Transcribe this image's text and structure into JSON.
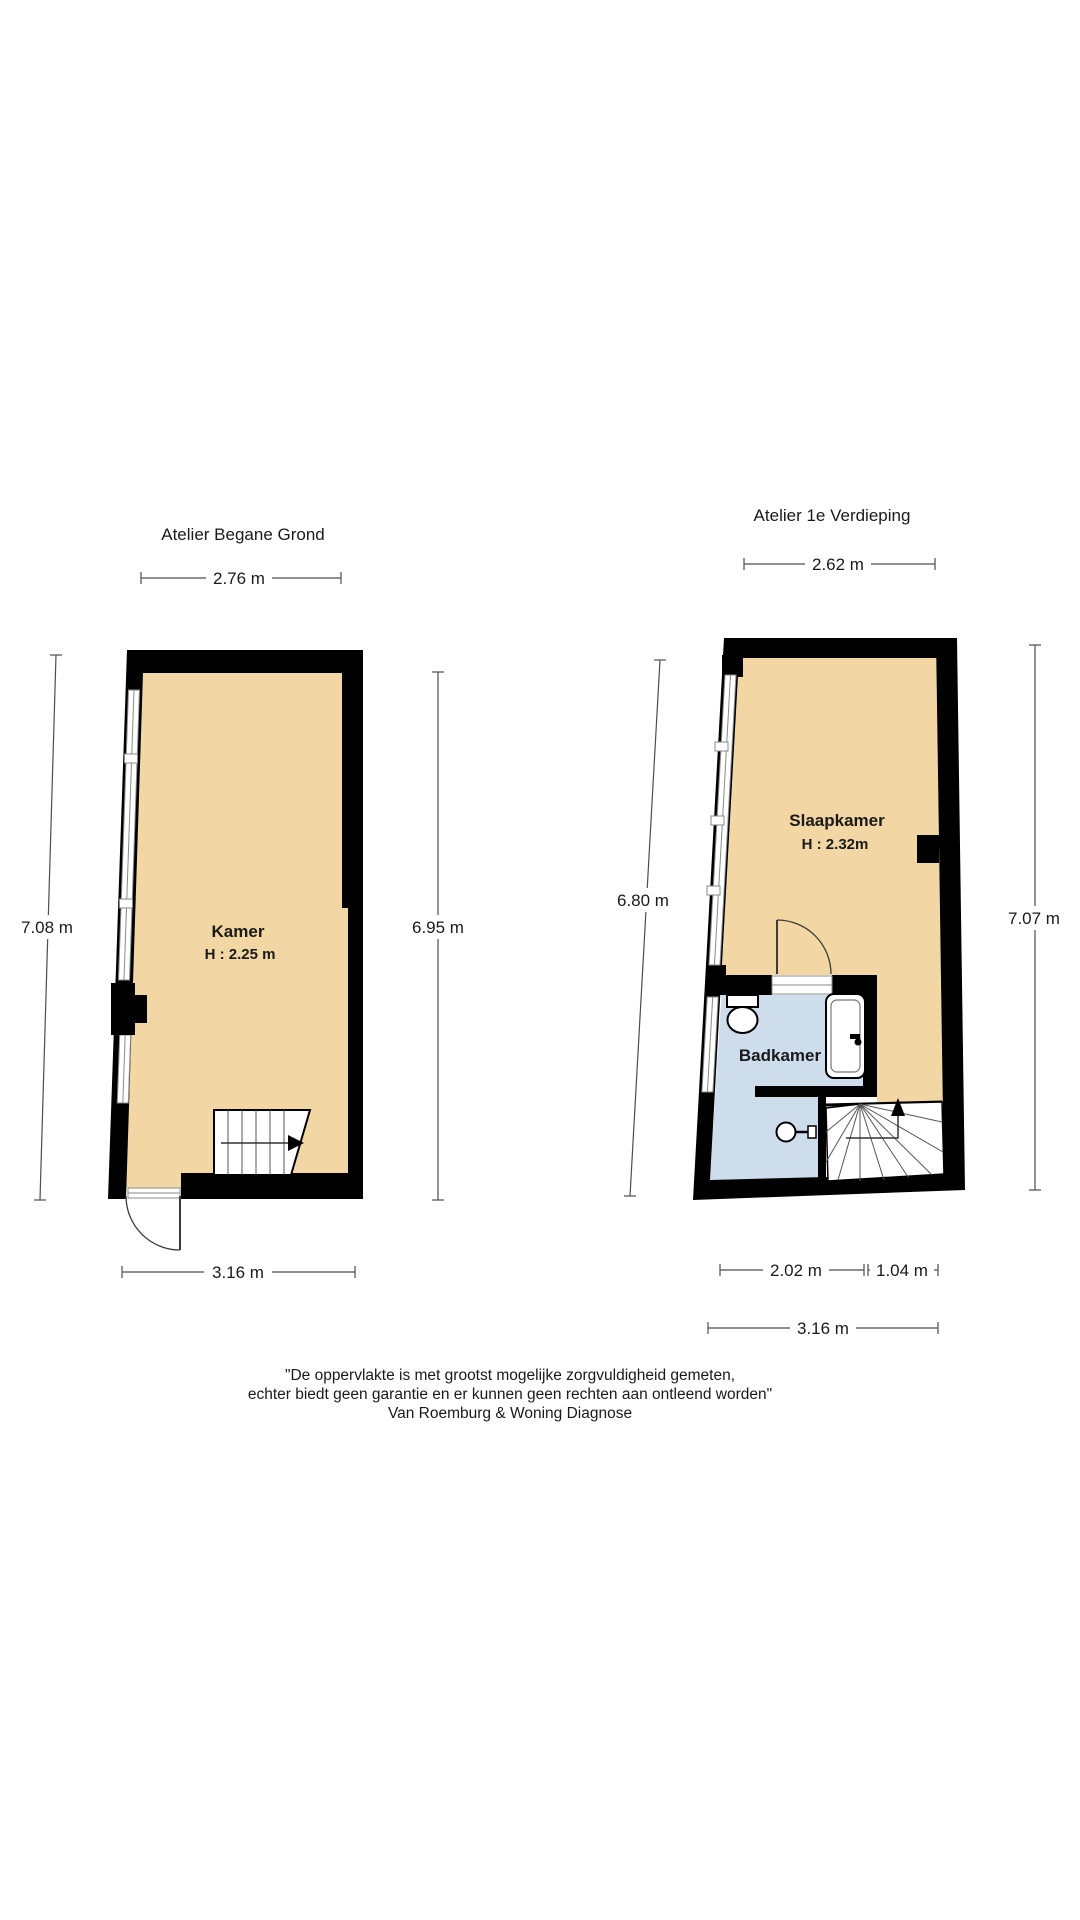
{
  "colors": {
    "wall": "#000000",
    "floor": "#F2D6A4",
    "bathroom": "#CEDDEC",
    "background": "#ffffff"
  },
  "ground_floor": {
    "title": "Atelier Begane Grond",
    "room_label": "Kamer",
    "room_height": "H : 2.25 m",
    "dim_top": "2.76 m",
    "dim_left": "7.08 m",
    "dim_right": "6.95 m",
    "dim_bottom": "3.16 m"
  },
  "first_floor": {
    "title": "Atelier 1e Verdieping",
    "slaapkamer_label": "Slaapkamer",
    "slaapkamer_height": "H : 2.32m",
    "badkamer_label": "Badkamer",
    "dim_top": "2.62 m",
    "dim_left": "6.80 m",
    "dim_right": "7.07 m",
    "dim_bottom_left": "2.02 m",
    "dim_bottom_right": "1.04 m",
    "dim_bottom_total": "3.16 m"
  },
  "disclaimer": {
    "line1": "\"De oppervlakte is met grootst mogelijke zorgvuldigheid gemeten,",
    "line2": "echter biedt geen garantie en er kunnen geen rechten aan ontleend worden\"",
    "line3": "Van Roemburg & Woning Diagnose"
  }
}
